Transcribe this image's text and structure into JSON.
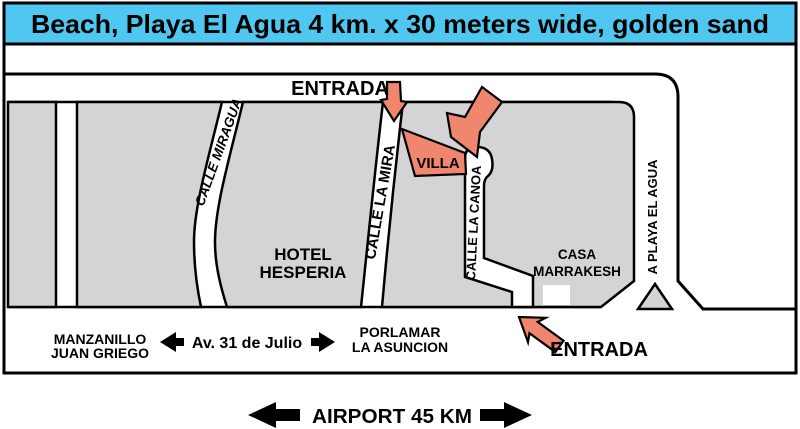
{
  "colors": {
    "banner_bg": "#4FC7F0",
    "accent": "#F0866E",
    "block_fill": "#D4D4D6"
  },
  "banner": {
    "title": "Beach, Playa El Agua 4 km. x 30 meters wide, golden sand"
  },
  "map": {
    "entrance_top": "ENTRADA",
    "entrance_bottom": "ENTRADA",
    "villa": "VILLA",
    "streets": {
      "miragua": "CALLE MIRAGUA",
      "la_mira": "CALLE LA MIRA",
      "la_canoa": "CALLE LA CANOA",
      "a_playa": "A PLAYA EL AGUA",
      "av_31": "Av. 31 de Julio"
    },
    "places": {
      "hotel_line1": "HOTEL",
      "hotel_line2": "HESPERIA",
      "casa_line1": "CASA",
      "casa_line2": "MARRAKESH"
    },
    "directions": {
      "west_line1": "MANZANILLO",
      "west_line2": "JUAN GRIEGO",
      "east_line1": "PORLAMAR",
      "east_line2": "LA ASUNCION"
    }
  },
  "footer": {
    "airport": "AIRPORT 45 KM"
  }
}
